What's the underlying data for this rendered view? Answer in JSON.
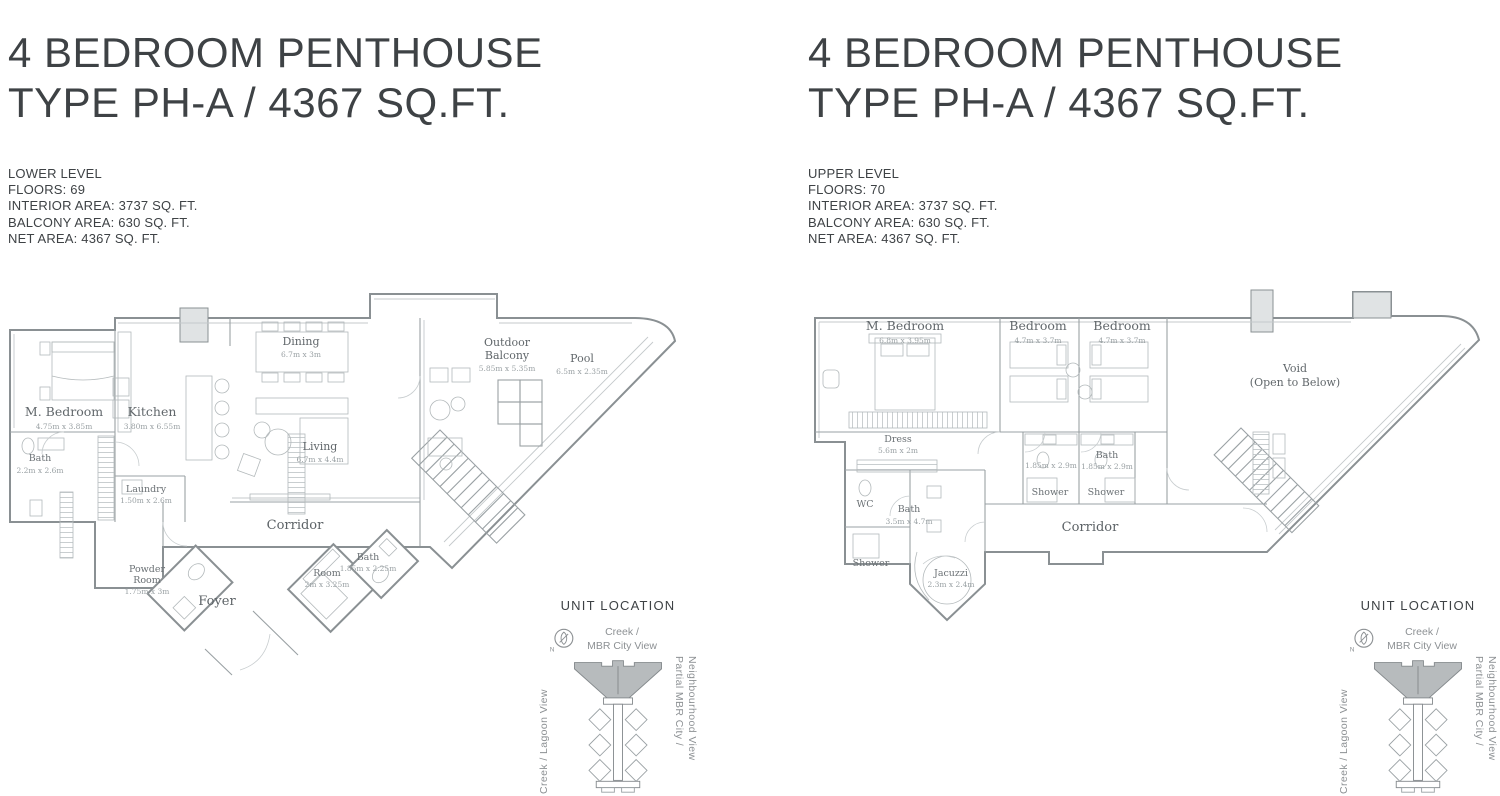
{
  "colors": {
    "wall": "#8a9093",
    "thin_line": "#9aa1a4",
    "furniture_line": "#b3b9bb",
    "room_label": "#61676b",
    "dim_label": "#9aa1a4",
    "title_text": "#3e4245",
    "muted_text": "#8d9194",
    "crown_fill": "#b7bbbd",
    "shaft_fill": "#e0e3e4"
  },
  "left_panel": {
    "title_line1": "4 BEDROOM PENTHOUSE",
    "title_line2": "TYPE PH-A / 4367 SQ.FT.",
    "specs": {
      "level": "LOWER LEVEL",
      "floors": "FLOORS: 69",
      "interior": "INTERIOR AREA: 3737 SQ. FT.",
      "balcony": "BALCONY AREA: 630 SQ. FT.",
      "net": "NET AREA: 4367 SQ. FT."
    },
    "rooms": {
      "m_bedroom": {
        "name": "M. Bedroom",
        "dims": "4.75m x 3.85m"
      },
      "bath": {
        "name": "Bath",
        "dims": "2.2m x 2.6m"
      },
      "kitchen": {
        "name": "Kitchen",
        "dims": "3.80m x 6.55m"
      },
      "laundry": {
        "name": "Laundry",
        "dims": "1.50m x 2.6m"
      },
      "dining": {
        "name": "Dining",
        "dims": "6.7m x 3m"
      },
      "living": {
        "name": "Living",
        "dims": "6.7m x 4.4m"
      },
      "outdoor_balcony": {
        "line1": "Outdoor",
        "line2": "Balcony",
        "dims": "5.85m x 5.35m"
      },
      "pool": {
        "name": "Pool",
        "dims": "6.5m x 2.35m"
      },
      "corridor": {
        "name": "Corridor"
      },
      "powder_room": {
        "line1": "Powder",
        "line2": "Room",
        "dims": "1.75m x 3m"
      },
      "foyer": {
        "name": "Foyer"
      },
      "room": {
        "name": "Room",
        "dims": "2m x 3.25m"
      },
      "bath2": {
        "name": "Bath",
        "dims": "1.85m x 2.25m"
      }
    }
  },
  "right_panel": {
    "title_line1": "4 BEDROOM PENTHOUSE",
    "title_line2": "TYPE PH-A / 4367 SQ.FT.",
    "specs": {
      "level": "UPPER LEVEL",
      "floors": "FLOORS: 70",
      "interior": "INTERIOR AREA: 3737 SQ. FT.",
      "balcony": "BALCONY AREA: 630 SQ. FT.",
      "net": "NET AREA: 4367 SQ. FT."
    },
    "rooms": {
      "m_bedroom": {
        "name": "M. Bedroom",
        "dims": "6.8m x 3.95m"
      },
      "bedroom1": {
        "name": "Bedroom",
        "dims": "4.7m x 3.7m"
      },
      "bedroom2": {
        "name": "Bedroom",
        "dims": "4.7m x 3.7m"
      },
      "dress": {
        "name": "Dress",
        "dims": "5.6m x 2m"
      },
      "bath1": {
        "dims": "1.85m x 2.9m"
      },
      "bath2": {
        "name": "Bath",
        "dims": "1.85m x 2.9m"
      },
      "shower1": {
        "name": "Shower"
      },
      "shower2": {
        "name": "Shower"
      },
      "wc": {
        "name": "WC"
      },
      "bath_master": {
        "name": "Bath",
        "dims": "3.5m x 4.7m"
      },
      "shower_master": {
        "name": "Shower"
      },
      "jacuzzi": {
        "name": "Jacuzzi",
        "dims": "2.3m x 2.4m"
      },
      "corridor": {
        "name": "Corridor"
      },
      "void": {
        "line1": "Void",
        "line2": "(Open to Below)"
      }
    }
  },
  "unit_location": {
    "title": "UNIT LOCATION",
    "compass": "N",
    "top_view_line1": "Creek /",
    "top_view_line2": "MBR City View",
    "left_view": "Creek / Lagoon View",
    "right_view_line1": "Partial MBR City /",
    "right_view_line2": "Neighbourhood View"
  }
}
